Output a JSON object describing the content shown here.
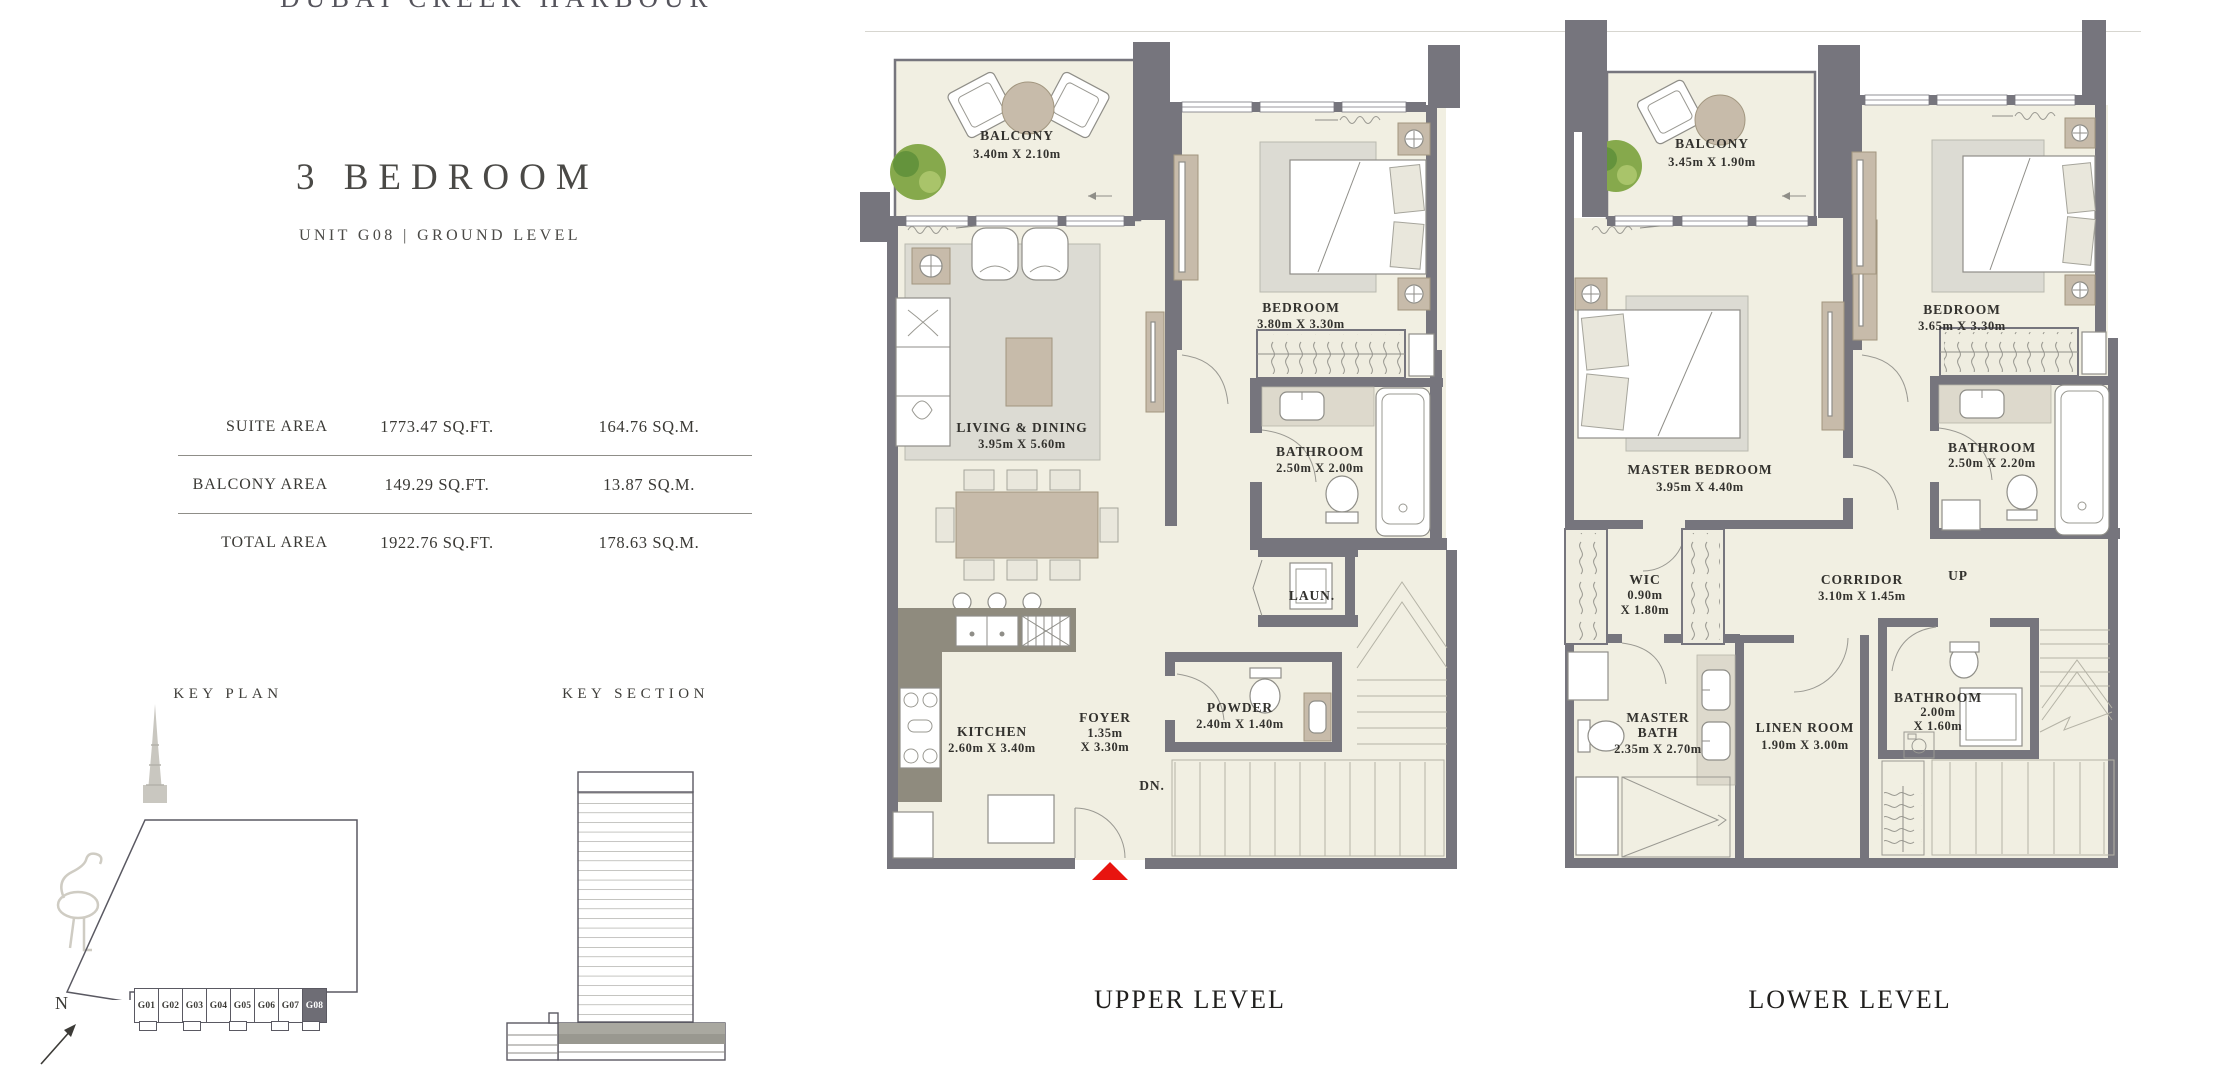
{
  "page": {
    "brand": "DUBAI CREEK HARBOUR",
    "title": "3 BEDROOM",
    "subtitle": "UNIT G08 | GROUND LEVEL"
  },
  "area_table": {
    "rows": [
      {
        "label": "SUITE AREA",
        "sqft": "1773.47 SQ.FT.",
        "sqm": "164.76 SQ.M."
      },
      {
        "label": "BALCONY AREA",
        "sqft": "149.29 SQ.FT.",
        "sqm": "13.87 SQ.M."
      },
      {
        "label": "TOTAL AREA",
        "sqft": "1922.76 SQ.FT.",
        "sqm": "178.63 SQ.M."
      }
    ]
  },
  "key_plan": {
    "title": "KEY PLAN",
    "north": "N",
    "units": [
      "G01",
      "G02",
      "G03",
      "G04",
      "G05",
      "G06",
      "G07",
      "G08"
    ],
    "highlighted_unit": "G08"
  },
  "key_section": {
    "title": "KEY SECTION"
  },
  "upper_plan": {
    "caption": "UPPER LEVEL",
    "stairs": "DN.",
    "rooms": {
      "balcony": {
        "name": "BALCONY",
        "dims": "3.40m X 2.10m"
      },
      "living": {
        "name": "LIVING & DINING",
        "dims": "3.95m X 5.60m"
      },
      "bedroom": {
        "name": "BEDROOM",
        "dims": "3.80m X 3.30m"
      },
      "bathroom": {
        "name": "BATHROOM",
        "dims": "2.50m X 2.00m"
      },
      "laundry": {
        "name": "LAUN."
      },
      "kitchen": {
        "name": "KITCHEN",
        "dims": "2.60m X 3.40m"
      },
      "foyer": {
        "name": "FOYER",
        "dims_line1": "1.35m",
        "dims_line2": "X 3.30m"
      },
      "powder": {
        "name": "POWDER",
        "dims": "2.40m X 1.40m"
      }
    }
  },
  "lower_plan": {
    "caption": "LOWER LEVEL",
    "stairs": "UP",
    "rooms": {
      "balcony": {
        "name": "BALCONY",
        "dims": "3.45m X 1.90m"
      },
      "master_bedroom": {
        "name": "MASTER BEDROOM",
        "dims": "3.95m X 4.40m"
      },
      "bedroom": {
        "name": "BEDROOM",
        "dims": "3.65m X 3.30m"
      },
      "bathroom": {
        "name": "BATHROOM",
        "dims": "2.50m X 2.20m"
      },
      "wic": {
        "name": "WIC",
        "dims_line1": "0.90m",
        "dims_line2": "X 1.80m"
      },
      "corridor": {
        "name": "CORRIDOR",
        "dims": "3.10m X 1.45m"
      },
      "master_bath": {
        "name_line1": "MASTER",
        "name_line2": "BATH",
        "dims": "2.35m X 2.70m"
      },
      "linen": {
        "name": "LINEN ROOM",
        "dims": "1.90m X 3.00m"
      },
      "bathroom2": {
        "name": "BATHROOM",
        "dims_line1": "2.00m",
        "dims_line2": "X 1.60m"
      }
    }
  },
  "colors": {
    "wall": "#76757d",
    "floor": "#f1efe2",
    "accent_red": "#e8140f",
    "tree_green": "#86a94c",
    "furniture_tan": "#c7bbaa",
    "text": "#3a3935"
  }
}
